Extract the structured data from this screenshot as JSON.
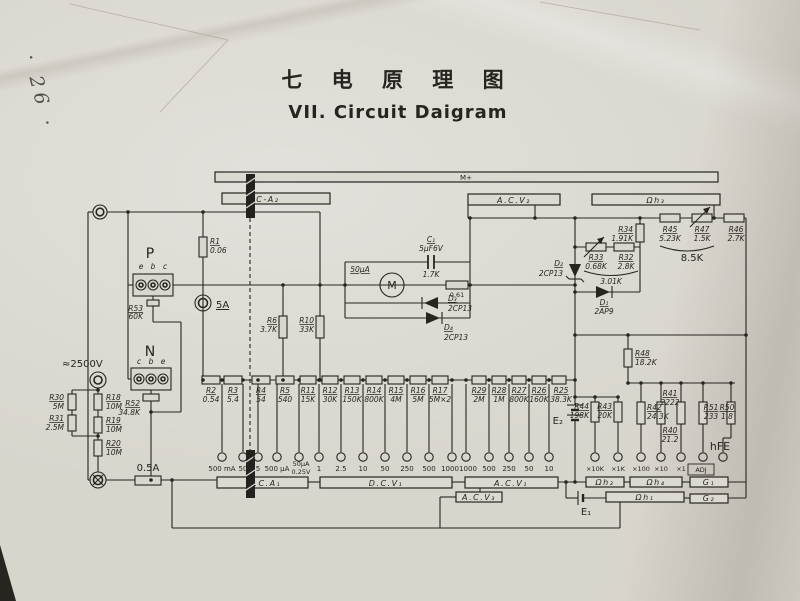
{
  "page": {
    "note": "· 26 ·",
    "title_cn": "七 电 原 理 图",
    "title_en": "VII. Circuit Daigram"
  },
  "decks": {
    "m_plus": "M+",
    "dc_a2": "DC-A₂",
    "ac_v2": "A.C.V₂",
    "ohm3": "Ωh₃",
    "dc_a1": "D.C.A₁",
    "dc_v1": "D.C.V₁",
    "ac_v1": "A.C.V₁",
    "ac_v3": "A.C.V₃",
    "ohm2": "Ωh₂",
    "ohm4": "Ωh₄",
    "g1": "G₁",
    "ohm1": "Ωh₁",
    "g2": "G₂"
  },
  "resistors": {
    "r1": {
      "n": "R1",
      "v": "0.06"
    },
    "r2": {
      "n": "R2",
      "v": "0.54"
    },
    "r3": {
      "n": "R3",
      "v": "5.4"
    },
    "r4": {
      "n": "R4",
      "v": "54"
    },
    "r5": {
      "n": "R5",
      "v": "540"
    },
    "r6": {
      "n": "R6",
      "v": "3.7K"
    },
    "r10": {
      "n": "R10",
      "v": "33K"
    },
    "r11": {
      "n": "R11",
      "v": "15K"
    },
    "r12": {
      "n": "R12",
      "v": "30K"
    },
    "r13": {
      "n": "R13",
      "v": "150K"
    },
    "r14": {
      "n": "R14",
      "v": "800K"
    },
    "r15": {
      "n": "R15",
      "v": "4M"
    },
    "r16": {
      "n": "R16",
      "v": "5M"
    },
    "r17": {
      "n": "R17",
      "v": "5M×2"
    },
    "r29": {
      "n": "R29",
      "v": "2M"
    },
    "r28": {
      "n": "R28",
      "v": "1M"
    },
    "r27": {
      "n": "R27",
      "v": "800K"
    },
    "r26": {
      "n": "R26",
      "v": "160K"
    },
    "r25": {
      "n": "R25",
      "v": "38.3K"
    },
    "r18": {
      "n": "R18",
      "v": "10M"
    },
    "r19": {
      "n": "R19",
      "v": "10M"
    },
    "r20": {
      "n": "R20",
      "v": "10M"
    },
    "r30": {
      "n": "R30",
      "v": "5M"
    },
    "r31": {
      "n": "R31",
      "v": "2.5M"
    },
    "r52": {
      "n": "R52",
      "v": "34.8K"
    },
    "r53": {
      "n": "R53",
      "v": "60K"
    },
    "r32": {
      "n": "R32",
      "v": "2.8K"
    },
    "r33": {
      "n": "R33",
      "v": "0.68K"
    },
    "r34": {
      "n": "R34",
      "v": "1.91K"
    },
    "r45": {
      "n": "R45",
      "v": "5.23K"
    },
    "r47": {
      "n": "R47",
      "v": "1.5K"
    },
    "r46": {
      "n": "R46",
      "v": "2.7K"
    },
    "r48": {
      "n": "R48",
      "v": "18.2K"
    },
    "r44": {
      "n": "R44",
      "v": "198K"
    },
    "r43": {
      "n": "R43",
      "v": "20K"
    },
    "r42": {
      "n": "R42",
      "v": "24.3K"
    },
    "r41": {
      "n": "R41",
      "v": "2222"
    },
    "r40": {
      "n": "R40",
      "v": "21.2"
    },
    "r51": {
      "n": "R51",
      "v": "233"
    },
    "r50": {
      "n": "R50",
      "v": "1.8"
    }
  },
  "diodes": {
    "d1": {
      "n": "D₁",
      "v": "2AP9"
    },
    "d2": {
      "n": "D₂",
      "v": "2CP13"
    },
    "d3": {
      "n": "D₃",
      "v": "2CP13"
    },
    "d4": {
      "n": "D₄",
      "v": "2CP13"
    }
  },
  "capacitor": {
    "n": "C₁",
    "v": "5μF6V"
  },
  "meter": {
    "symbol": "M",
    "range": "50μA",
    "coil": "1.7K",
    "shunt": "0.61"
  },
  "fuses": {
    "f1": "5A",
    "f2": "0.5A"
  },
  "groups": {
    "sum1": "3.01K",
    "sum2": "8.5K"
  },
  "input": {
    "hv": "≈2500V"
  },
  "batteries": {
    "e1": "E₁",
    "e2": "E₂"
  },
  "sockets": {
    "p": {
      "label": "P",
      "pins": [
        "e",
        "b",
        "c"
      ]
    },
    "n": {
      "label": "N",
      "pins": [
        "c",
        "b",
        "e"
      ]
    }
  },
  "contacts": [
    {
      "l1": "500 mA"
    },
    {
      "l1": "50"
    },
    {
      "l1": "5"
    },
    {
      "l1": "500 μA"
    },
    {
      "l1": "50μA",
      "l2": "0.25V"
    },
    {
      "l1": "1"
    },
    {
      "l1": "2.5"
    },
    {
      "l1": "10"
    },
    {
      "l1": "50"
    },
    {
      "l1": "250"
    },
    {
      "l1": "500"
    },
    {
      "l1": "1000"
    },
    {
      "l1": "1000"
    },
    {
      "l1": "500"
    },
    {
      "l1": "250"
    },
    {
      "l1": "50"
    },
    {
      "l1": "10"
    },
    {
      "l1": "×10K"
    },
    {
      "l1": "×1K"
    },
    {
      "l1": "×100"
    },
    {
      "l1": "×10"
    },
    {
      "l1": "×1"
    },
    {
      "l1": "ADJ"
    },
    {
      "l1": "hFE"
    }
  ]
}
